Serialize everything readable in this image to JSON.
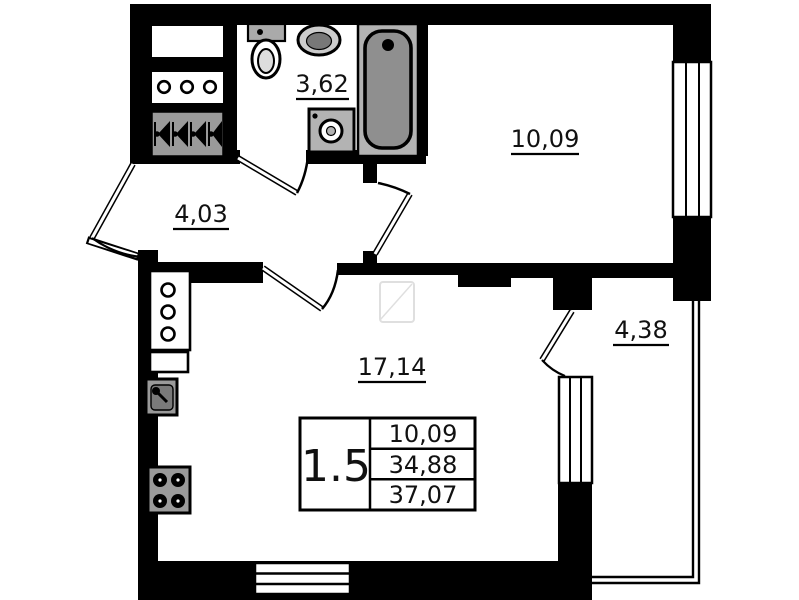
{
  "plan": {
    "type": "apartment-floor-plan",
    "rooms": [
      {
        "name": "bathroom",
        "area": "3,62"
      },
      {
        "name": "bedroom",
        "area": "10,09"
      },
      {
        "name": "hallway",
        "area": "4,03"
      },
      {
        "name": "living-room-kitchen",
        "area": "17,14"
      },
      {
        "name": "balcony",
        "area": "4,38"
      }
    ],
    "legend": {
      "room_count": "1.5",
      "living_area": "10,09",
      "apartment_area": "34,88",
      "total_area": "37,07"
    },
    "icons": [
      "toilet",
      "wash-basin",
      "bathtub",
      "washing-machine",
      "wardrobe",
      "shoe-cabinet",
      "coat-hangers",
      "kitchen-counter",
      "kitchen-sink",
      "stove",
      "window",
      "door-swing"
    ],
    "colors": {
      "walls": "#000000",
      "fixtures": "#9a9a9a",
      "background": "#ffffff"
    }
  }
}
